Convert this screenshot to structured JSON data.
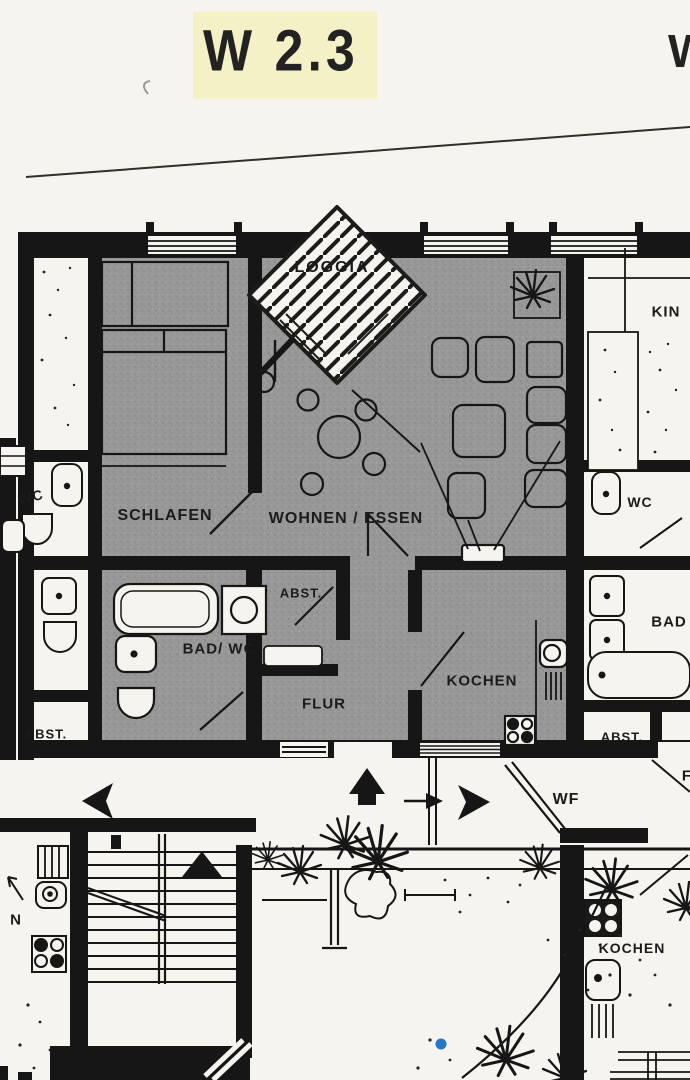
{
  "document": {
    "unit_label": "W 2.3",
    "adjacent_unit_label_partial": "W",
    "colors": {
      "paper": "#f6f4ef",
      "ink": "#161616",
      "unit_fill": "#989898",
      "title_highlight": "#f5f1c6",
      "marker_dot": "#1f78cb"
    }
  },
  "unit_rooms": {
    "loggia": "LOGGIA",
    "schlafen": "SCHLAFEN",
    "wohnen_essen": "WOHNEN / ESSEN",
    "abst": "ABST.",
    "bad_wc": "BAD/ WC",
    "flur": "FLUR",
    "kochen": "KOCHEN"
  },
  "neighbor_rooms": {
    "left_wc": "WC",
    "left_abst": "ABST.",
    "left_kochen_partial": "N",
    "right_kinder_partial": "KIN",
    "right_wc": "WC",
    "right_bad_partial": "BAD",
    "right_abst": "ABST.",
    "right_flur_partial": "F",
    "bottom_right_kochen": "KOCHEN",
    "stairwell_wf": "WF"
  }
}
